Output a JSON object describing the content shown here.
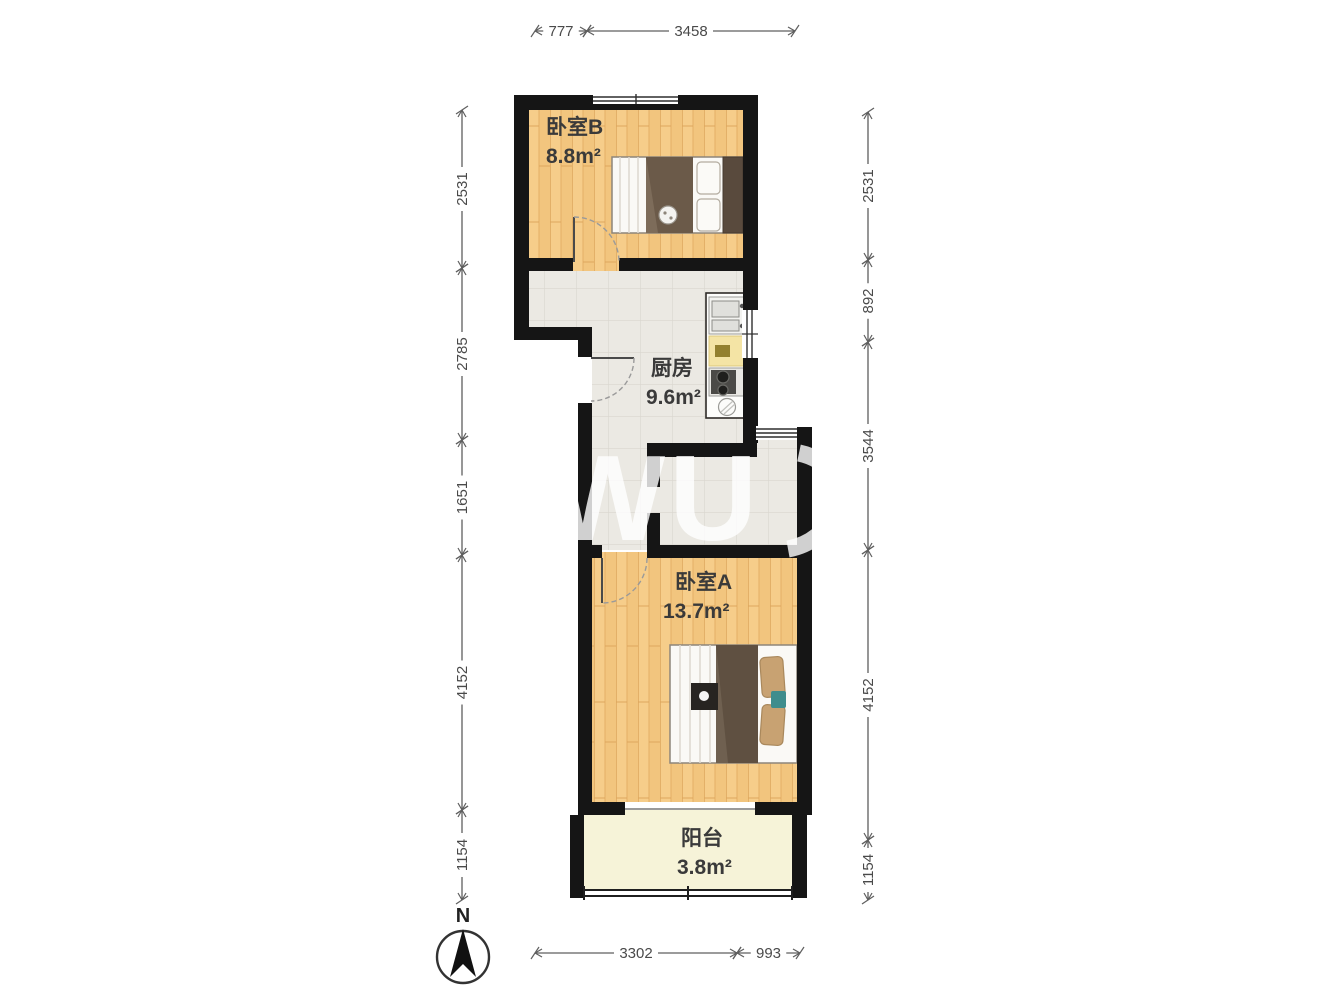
{
  "title": "apartment-floor-plan",
  "watermark": {
    "text": "WU",
    "opacity": 0.8
  },
  "compass": {
    "label": "N"
  },
  "rooms": [
    {
      "id": "bedroom-b",
      "name": "卧室B",
      "area": "8.8m²",
      "floor": "wood"
    },
    {
      "id": "kitchen",
      "name": "厨房",
      "area": "9.6m²",
      "floor": "tile"
    },
    {
      "id": "bedroom-a",
      "name": "卧室A",
      "area": "13.7m²",
      "floor": "wood"
    },
    {
      "id": "balcony",
      "name": "阳台",
      "area": "3.8m²",
      "floor": "plain"
    }
  ],
  "colors": {
    "wall": "#151515",
    "wood_floor": "#f2c57e",
    "tile_floor": "#ebe9e3",
    "balcony_floor": "#f6f3d8",
    "blanket_brown": "#5f5041",
    "pillow_tan": "#c8a272",
    "counter_yellow": "#f4e4a5",
    "dimension_line": "#5f5f5f",
    "label_text": "#3a3a3a"
  },
  "dimensions": {
    "unit": "mm",
    "chains": [
      {
        "id": "top",
        "orientation": "h",
        "pos": 31,
        "segments": [
          {
            "value": "777",
            "from": 535,
            "to": 587
          },
          {
            "value": "3458",
            "from": 587,
            "to": 795
          }
        ]
      },
      {
        "id": "bottom",
        "orientation": "h",
        "pos": 953,
        "segments": [
          {
            "value": "3302",
            "from": 535,
            "to": 737
          },
          {
            "value": "993",
            "from": 737,
            "to": 800
          }
        ]
      },
      {
        "id": "left",
        "orientation": "v",
        "pos": 462,
        "segments": [
          {
            "value": "2531",
            "from": 110,
            "to": 268
          },
          {
            "value": "2785",
            "from": 268,
            "to": 440
          },
          {
            "value": "1651",
            "from": 440,
            "to": 555
          },
          {
            "value": "4152",
            "from": 555,
            "to": 810
          },
          {
            "value": "1154",
            "from": 810,
            "to": 900
          }
        ]
      },
      {
        "id": "right",
        "orientation": "v",
        "pos": 868,
        "segments": [
          {
            "value": "2531",
            "from": 112,
            "to": 260
          },
          {
            "value": "892",
            "from": 260,
            "to": 342
          },
          {
            "value": "3544",
            "from": 342,
            "to": 550
          },
          {
            "value": "4152",
            "from": 550,
            "to": 840
          },
          {
            "value": "1154",
            "from": 840,
            "to": 900
          }
        ]
      }
    ]
  }
}
